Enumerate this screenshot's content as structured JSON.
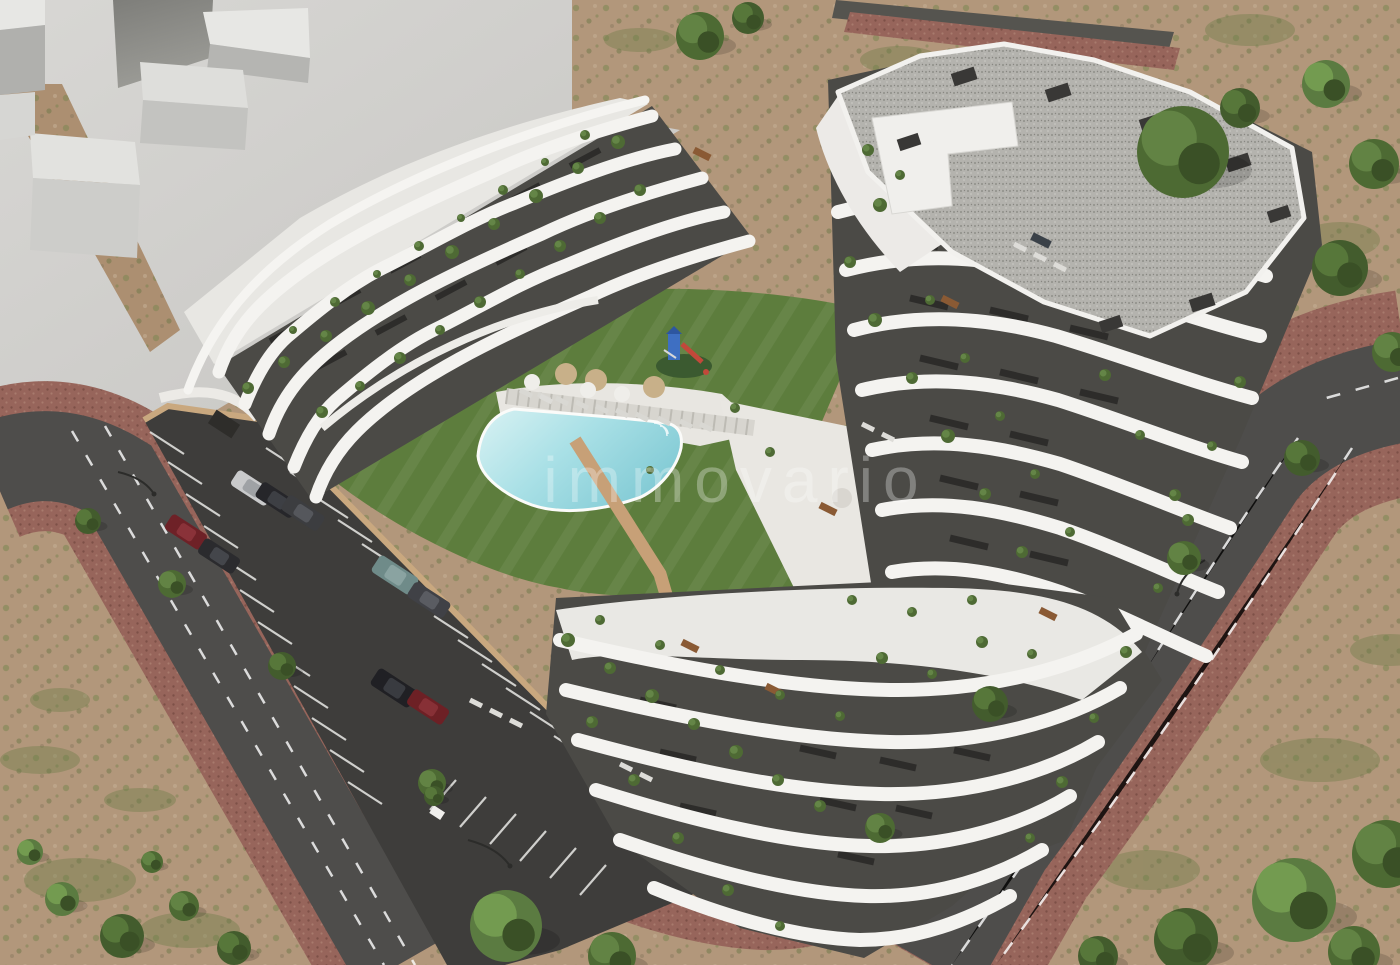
{
  "scene": {
    "type": "aerial-3d-architectural-render-of-apartment-complex"
  },
  "watermark": {
    "text": "immovario",
    "color": "#ffffff",
    "opacity": 0.3,
    "font_px": 64
  },
  "palette": {
    "dirt": "#b2977b",
    "scrub_green": "#75824e",
    "plaza": "#d2d1ce",
    "massing_light": "#e7e7e4",
    "massing_mid": "#c3c3c0",
    "massing_dark": "#8f8f8b",
    "road": "#4e4d4b",
    "paver": "#97655b",
    "parking_asphalt": "#3e3d3b",
    "wall_tan": "#c7a077",
    "building_white": "#f3f2ef",
    "facade_dark": "#4b4a46",
    "window_dark": "#2d2c2a",
    "terrace_light": "#e9e8e4",
    "roof_gravel": "#b4b3ae",
    "lawn": "#5d7d3d",
    "pool": "#a9dfe5",
    "lane_mark": "#ffffff"
  },
  "pool_area": {
    "tan_umbrellas": 3,
    "white_umbrellas": 3,
    "has_playground": true
  },
  "cars": [
    {
      "x": 252,
      "y": 488,
      "angle": 33,
      "w": 42,
      "h": 18,
      "body": "#c9cacb",
      "roof": "#9fa2a5"
    },
    {
      "x": 277,
      "y": 500,
      "angle": 33,
      "w": 43,
      "h": 18,
      "body": "#26262a",
      "roof": "#3d3f44"
    },
    {
      "x": 303,
      "y": 513,
      "angle": 33,
      "w": 43,
      "h": 18,
      "body": "#3c3d40",
      "roof": "#55575c"
    },
    {
      "x": 186,
      "y": 532,
      "angle": 33,
      "w": 42,
      "h": 18,
      "body": "#6e2127",
      "roof": "#8a3239"
    },
    {
      "x": 219,
      "y": 556,
      "angle": 33,
      "w": 42,
      "h": 18,
      "body": "#2b2b2e",
      "roof": "#44464b"
    },
    {
      "x": 395,
      "y": 575,
      "angle": 33,
      "w": 46,
      "h": 20,
      "body": "#6f8b89",
      "roof": "#8aa3a1"
    },
    {
      "x": 429,
      "y": 600,
      "angle": 33,
      "w": 43,
      "h": 18,
      "body": "#404146",
      "roof": "#5a5c62"
    },
    {
      "x": 394,
      "y": 688,
      "angle": 33,
      "w": 46,
      "h": 20,
      "body": "#202024",
      "roof": "#393b40"
    },
    {
      "x": 428,
      "y": 707,
      "angle": 33,
      "w": 42,
      "h": 18,
      "body": "#6d2025",
      "roof": "#873036"
    }
  ],
  "trees": [
    {
      "x": 700,
      "y": 36,
      "r": 24,
      "t": 0
    },
    {
      "x": 748,
      "y": 18,
      "r": 16,
      "t": 1
    },
    {
      "x": 1183,
      "y": 152,
      "r": 46,
      "t": 0
    },
    {
      "x": 1240,
      "y": 108,
      "r": 20,
      "t": 1
    },
    {
      "x": 1326,
      "y": 84,
      "r": 24,
      "t": 2
    },
    {
      "x": 1374,
      "y": 164,
      "r": 25,
      "t": 0
    },
    {
      "x": 1340,
      "y": 268,
      "r": 28,
      "t": 1
    },
    {
      "x": 1392,
      "y": 352,
      "r": 20,
      "t": 0
    },
    {
      "x": 1302,
      "y": 458,
      "r": 18,
      "t": 1
    },
    {
      "x": 1184,
      "y": 558,
      "r": 17,
      "t": 0
    },
    {
      "x": 990,
      "y": 704,
      "r": 18,
      "t": 1
    },
    {
      "x": 880,
      "y": 828,
      "r": 15,
      "t": 0
    },
    {
      "x": 1294,
      "y": 900,
      "r": 42,
      "t": 2
    },
    {
      "x": 1386,
      "y": 854,
      "r": 34,
      "t": 0
    },
    {
      "x": 1186,
      "y": 940,
      "r": 32,
      "t": 1
    },
    {
      "x": 1354,
      "y": 952,
      "r": 26,
      "t": 0
    },
    {
      "x": 1098,
      "y": 956,
      "r": 20,
      "t": 1
    },
    {
      "x": 506,
      "y": 926,
      "r": 36,
      "t": 2
    },
    {
      "x": 612,
      "y": 956,
      "r": 24,
      "t": 0
    },
    {
      "x": 88,
      "y": 521,
      "r": 13,
      "t": 1
    },
    {
      "x": 172,
      "y": 584,
      "r": 14,
      "t": 0
    },
    {
      "x": 282,
      "y": 666,
      "r": 14,
      "t": 1
    },
    {
      "x": 432,
      "y": 783,
      "r": 14,
      "t": 0
    },
    {
      "x": 62,
      "y": 899,
      "r": 17,
      "t": 2
    },
    {
      "x": 122,
      "y": 936,
      "r": 22,
      "t": 1
    },
    {
      "x": 184,
      "y": 906,
      "r": 15,
      "t": 0
    },
    {
      "x": 234,
      "y": 948,
      "r": 17,
      "t": 1
    },
    {
      "x": 30,
      "y": 852,
      "r": 13,
      "t": 2
    },
    {
      "x": 152,
      "y": 862,
      "r": 11,
      "t": 0
    },
    {
      "x": 434,
      "y": 796,
      "r": 10,
      "t": 1
    }
  ],
  "terrace_plants": [
    [
      618,
      142,
      7
    ],
    [
      578,
      168,
      6
    ],
    [
      536,
      196,
      7
    ],
    [
      494,
      224,
      6
    ],
    [
      452,
      252,
      7
    ],
    [
      410,
      280,
      6
    ],
    [
      368,
      308,
      7
    ],
    [
      326,
      336,
      6
    ],
    [
      284,
      362,
      6
    ],
    [
      248,
      388,
      6
    ],
    [
      640,
      190,
      6
    ],
    [
      600,
      218,
      6
    ],
    [
      560,
      246,
      6
    ],
    [
      520,
      274,
      5
    ],
    [
      480,
      302,
      6
    ],
    [
      440,
      330,
      5
    ],
    [
      400,
      358,
      6
    ],
    [
      360,
      386,
      5
    ],
    [
      322,
      412,
      6
    ],
    [
      585,
      135,
      5
    ],
    [
      545,
      162,
      4
    ],
    [
      503,
      190,
      5
    ],
    [
      461,
      218,
      4
    ],
    [
      419,
      246,
      5
    ],
    [
      377,
      274,
      4
    ],
    [
      335,
      302,
      5
    ],
    [
      293,
      330,
      4
    ],
    [
      880,
      205,
      7
    ],
    [
      850,
      262,
      6
    ],
    [
      875,
      320,
      7
    ],
    [
      912,
      378,
      6
    ],
    [
      948,
      436,
      7
    ],
    [
      985,
      494,
      6
    ],
    [
      1022,
      552,
      6
    ],
    [
      930,
      300,
      5
    ],
    [
      965,
      358,
      5
    ],
    [
      1000,
      416,
      5
    ],
    [
      1035,
      474,
      5
    ],
    [
      1070,
      532,
      5
    ],
    [
      1105,
      375,
      6
    ],
    [
      1140,
      435,
      5
    ],
    [
      1175,
      495,
      6
    ],
    [
      1240,
      382,
      6
    ],
    [
      1212,
      446,
      5
    ],
    [
      1188,
      520,
      6
    ],
    [
      1158,
      588,
      5
    ],
    [
      1126,
      652,
      6
    ],
    [
      1094,
      718,
      5
    ],
    [
      1062,
      782,
      6
    ],
    [
      1030,
      838,
      5
    ],
    [
      568,
      640,
      7
    ],
    [
      610,
      668,
      6
    ],
    [
      652,
      696,
      7
    ],
    [
      694,
      724,
      6
    ],
    [
      736,
      752,
      7
    ],
    [
      778,
      780,
      6
    ],
    [
      820,
      806,
      6
    ],
    [
      600,
      620,
      5
    ],
    [
      660,
      645,
      5
    ],
    [
      720,
      670,
      5
    ],
    [
      780,
      695,
      5
    ],
    [
      840,
      716,
      5
    ],
    [
      882,
      658,
      6
    ],
    [
      932,
      674,
      5
    ],
    [
      982,
      642,
      6
    ],
    [
      1032,
      654,
      5
    ],
    [
      592,
      722,
      6
    ],
    [
      634,
      780,
      6
    ],
    [
      678,
      838,
      6
    ],
    [
      728,
      890,
      6
    ],
    [
      780,
      926,
      5
    ],
    [
      852,
      600,
      5
    ],
    [
      912,
      612,
      5
    ],
    [
      972,
      600,
      5
    ],
    [
      735,
      408,
      5
    ],
    [
      770,
      452,
      5
    ],
    [
      650,
      470,
      4
    ],
    [
      868,
      150,
      6
    ],
    [
      900,
      175,
      5
    ]
  ]
}
